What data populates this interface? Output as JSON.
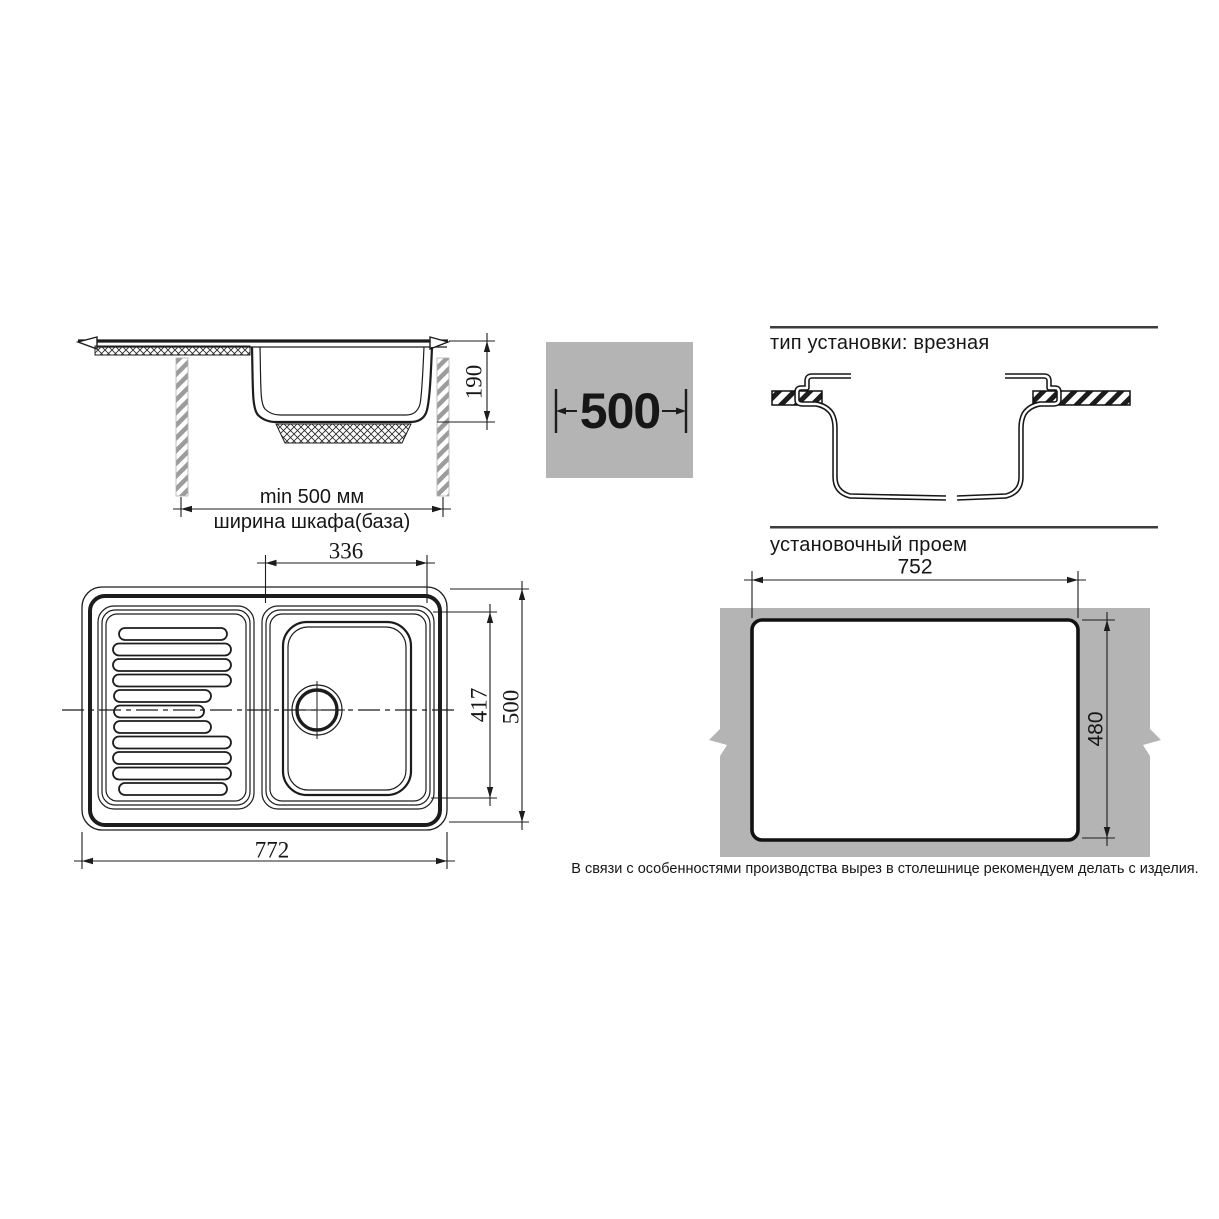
{
  "side_view": {
    "depth_label": "190",
    "min_width_label": "min 500 мм",
    "cabinet_label": "ширина шкафа(база)"
  },
  "badge": {
    "value": "500"
  },
  "install_type": {
    "title": "тип установки: врезная"
  },
  "top_view": {
    "bowl_width": "336",
    "bowl_depth": "417",
    "overall_depth": "500",
    "overall_width": "772"
  },
  "opening": {
    "title": "установочный проем",
    "width": "752",
    "height": "480",
    "note": "В связи с особенностями производства вырез в столешнице рекомендуем делать с изделия."
  },
  "colors": {
    "line": "#1c1c1c",
    "slab_gray": "#b4b4b4",
    "hatch_gray": "#9c9c9c",
    "rule_gray": "#3d3d3d"
  }
}
